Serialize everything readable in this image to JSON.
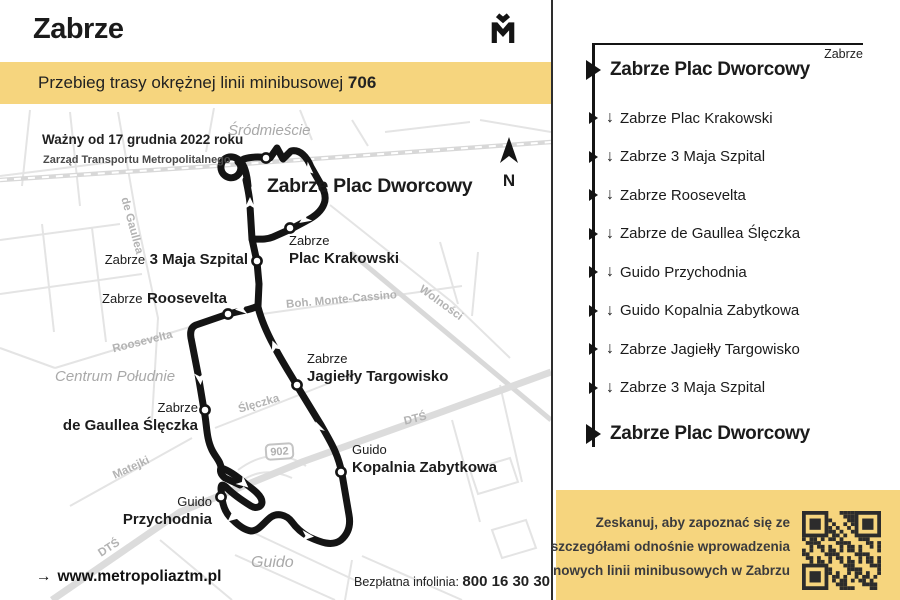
{
  "colors": {
    "accent_yellow": "#F6D57E",
    "ink": "#1b1b1b",
    "route_black": "#141414",
    "map_gray": "#e4e4e4"
  },
  "header": {
    "title": "Zabrze",
    "banner_text": "Przebieg trasy okrężnej linii minibusowej",
    "banner_line": "706",
    "logo": "metropolia-gzm-logo"
  },
  "map": {
    "validity": "Ważny od 17 grudnia 2022 roku",
    "operator": "Zarząd Transportu Metropolitalnego",
    "compass_letter": "N",
    "road_shield": "902",
    "terminal_label": "Zabrze Plac Dworcowy",
    "stops": [
      {
        "prefix": "Zabrze",
        "name": "Plac Krakowski"
      },
      {
        "prefix": "Zabrze",
        "name": "3 Maja Szpital"
      },
      {
        "prefix": "Zabrze",
        "name": "Roosevelta"
      },
      {
        "prefix": "Zabrze",
        "name": "de Gaullea Ślęczka"
      },
      {
        "prefix": "Guido",
        "name": "Przychodnia"
      },
      {
        "prefix": "Guido",
        "name": "Kopalnia Zabytkowa"
      },
      {
        "prefix": "Zabrze",
        "name": "Jagiełły Targowisko"
      }
    ],
    "area_labels": {
      "srodmiescie": "Śródmieście",
      "centrum_poludnie": "Centrum Południe",
      "guido": "Guido"
    },
    "street_labels": {
      "de_gaullea": "de Gaullea",
      "roosevelta": "Roosevelta",
      "monte_cassino": "Boh. Monte-Cassino",
      "wolnosci": "Wolności",
      "sleczka": "Ślęczka",
      "matejki": "Matejki",
      "dts_a": "DTŚ",
      "dts_b": "DTŚ"
    }
  },
  "footer": {
    "arrow": "→",
    "website": "www.metropoliaztm.pl",
    "infoline_label": "Bezpłatna infolinia:",
    "infoline_number": "800 16 30 30"
  },
  "route_panel": {
    "corner_label": "Zabrze",
    "down_symbol": "↓",
    "stops": [
      {
        "label": "Zabrze Plac Dworcowy",
        "type": "terminal"
      },
      {
        "label": "Zabrze Plac Krakowski",
        "type": "stop"
      },
      {
        "label": "Zabrze 3 Maja Szpital",
        "type": "stop"
      },
      {
        "label": "Zabrze Roosevelta",
        "type": "stop"
      },
      {
        "label": "Zabrze de Gaullea Ślęczka",
        "type": "stop"
      },
      {
        "label": "Guido Przychodnia",
        "type": "stop"
      },
      {
        "label": "Guido Kopalnia Zabytkowa",
        "type": "stop"
      },
      {
        "label": "Zabrze Jagiełły Targowisko",
        "type": "stop"
      },
      {
        "label": "Zabrze 3 Maja Szpital",
        "type": "stop"
      },
      {
        "label": "Zabrze Plac Dworcowy",
        "type": "terminal"
      }
    ]
  },
  "qr_box": {
    "lines": [
      "Zeskanuj, aby zapoznać się ze",
      "szczegółami odnośnie wprowadzenia",
      "nowych linii minibusowych w Zabrzu"
    ]
  }
}
